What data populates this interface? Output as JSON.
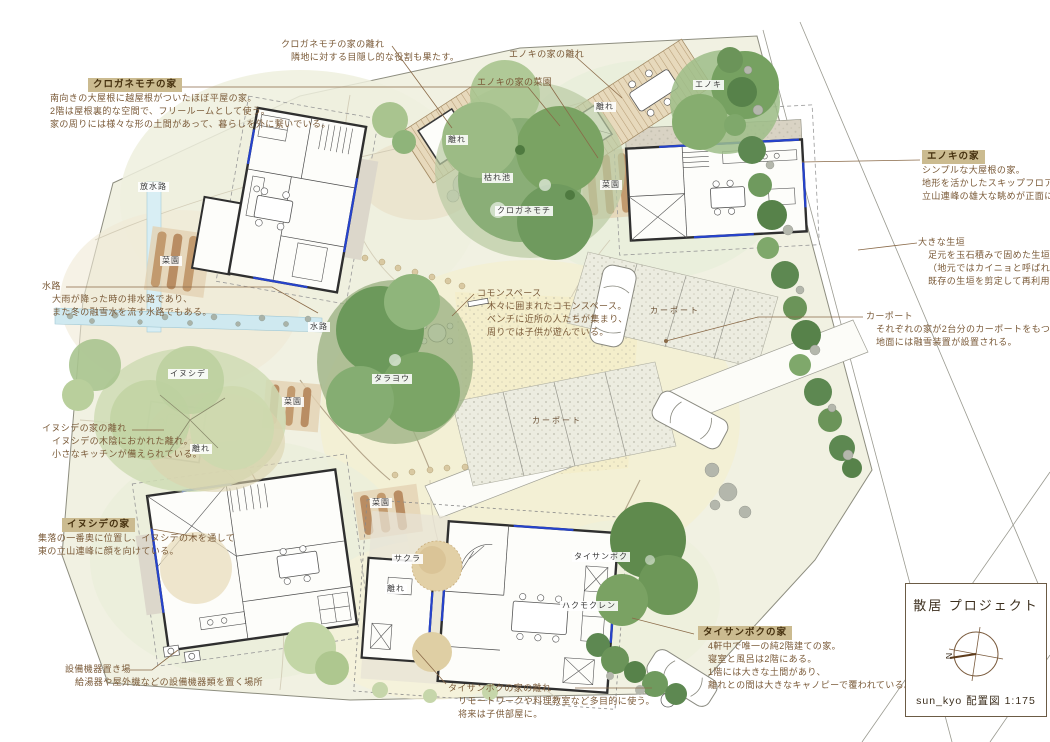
{
  "title_block": {
    "project_title": "散居 プロジェクト",
    "sheet_title": "sun_kyo 配置図  1:175",
    "north_label": "N"
  },
  "colors": {
    "annotation_text": "#7a5a38",
    "label_box_bg": "#cbbb90",
    "window_blue": "#2643cc",
    "stream_blue": "#cfe9f0",
    "hedge_green": "#5d8851",
    "site_base": "#f1f1e2"
  },
  "callouts": {
    "kuroganemochi_house": {
      "label": "クロガネモチの家",
      "lines": [
        "南向きの大屋根に越屋根がついたほぼ平屋の家。",
        "2階は屋根裏的な空間で、フリールームとして使う。",
        "家の周りには様々な形の土間があって、暮らしを外に繋いでいる。"
      ]
    },
    "kuroganemochi_hanare": {
      "label": "クロガネモチの家の離れ",
      "lines": [
        "隣地に対する目隠し的な役割も果たす。"
      ]
    },
    "enoki_hanare": {
      "label": "エノキの家の離れ"
    },
    "enoki_saien": {
      "label": "エノキの家の菜園"
    },
    "enoki_house": {
      "label": "エノキの家",
      "lines": [
        "シンプルな大屋根の家。",
        "地形を活かしたスキップフロアー構成で",
        "立山連峰の雄大な眺めが正面にある。"
      ]
    },
    "big_hedge": {
      "label": "大きな生垣",
      "lines": [
        "足元を玉石積みで固めた生垣防風林。",
        "（地元ではカイニョと呼ばれている）",
        "既存の生垣を剪定して再利用している。"
      ]
    },
    "carport": {
      "label": "カーポート",
      "lines": [
        "それぞれの家が2台分のカーポートをもつ。",
        "地面には融雪装置が設置される。"
      ]
    },
    "suiro": {
      "label": "水路",
      "lines": [
        "大雨が降った時の排水路であり、",
        "また冬の融雪水を流す水路でもある。"
      ]
    },
    "common_space": {
      "label": "コモンスペース",
      "lines": [
        "木々に囲まれたコモンスペース。",
        "ベンチに近所の人たちが集まり、",
        "周りでは子供が遊んでいる。"
      ]
    },
    "inushide_hanare": {
      "label": "イヌシデの家の離れ",
      "lines": [
        "イヌシデの木陰におかれた離れ。",
        "小さなキッチンが備えられている。"
      ]
    },
    "inushide_house": {
      "label": "イヌシデの家",
      "lines": [
        "集落の一番奥に位置し、イヌシデの木を通して",
        "東の立山連峰に顔を向けている。"
      ]
    },
    "setsubi": {
      "label": "設備機器置き場",
      "lines": [
        "給湯器や屋外機などの設備機器類を置く場所"
      ]
    },
    "taisanboku_hanare": {
      "label": "タイサンボクの家の離れ",
      "lines": [
        "リモートワークや料理教室など多目的に使う。",
        "将来は子供部屋に。"
      ]
    },
    "taisanboku_house": {
      "label": "タイサンボクの家",
      "lines": [
        "4軒中で唯一の純2階建ての家。",
        "寝室と風呂は2階にある。",
        "1階には大きな土間があり、",
        "離れとの間は大きなキャノピーで覆われている。"
      ]
    }
  },
  "plan_labels": {
    "hosuiro": "放水路",
    "saien_nw": "菜園",
    "suiro": "水路",
    "inushide": "イヌシデ",
    "saien_mid": "菜園",
    "hanare_inushide": "離れ",
    "tarayo": "タラヨウ",
    "kareike": "枯れ池",
    "kuroganemochi": "クロガネモチ",
    "saien_enoki": "菜園",
    "hanare_kurogane": "離れ",
    "hanare_enoki": "離れ",
    "enoki": "エノキ",
    "carport_a": "カーポート",
    "carport_b": "カーポート",
    "saien_s": "菜園",
    "sakura": "サクラ",
    "hanare_taisanboku": "離れ",
    "taisanboku": "タイサンボク",
    "hakumokuren": "ハクモクレン"
  }
}
